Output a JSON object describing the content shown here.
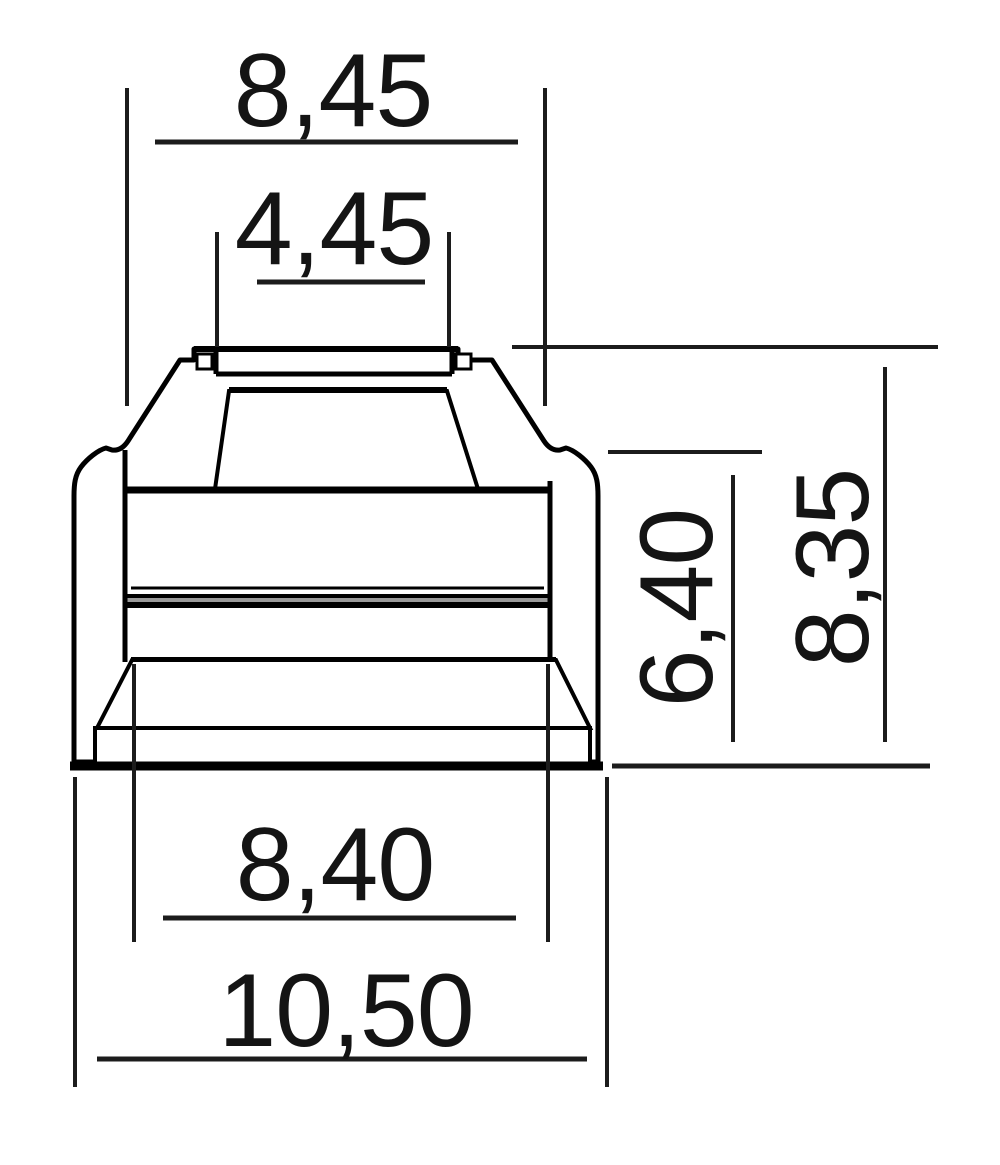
{
  "diagram": {
    "type": "technical-drawing",
    "subject": "valve-stem-seal-cross-section",
    "decimal_style": "comma",
    "colors": {
      "background": "#ffffff",
      "outline": "#000000",
      "body_fill": "#b0b0b0",
      "groove_fill": "#9a9a9a",
      "dimension_line": "#1c1c1c"
    },
    "dimensions": [
      {
        "id": "top-bore-width",
        "value": "8,45",
        "orientation": "horizontal",
        "position": "top"
      },
      {
        "id": "stem-bore-width",
        "value": "4,45",
        "orientation": "horizontal",
        "position": "top"
      },
      {
        "id": "inner-height",
        "value": "6,40",
        "orientation": "vertical",
        "position": "right"
      },
      {
        "id": "overall-height",
        "value": "8,35",
        "orientation": "vertical",
        "position": "right"
      },
      {
        "id": "base-bore-width",
        "value": "8,40",
        "orientation": "horizontal",
        "position": "bottom"
      },
      {
        "id": "overall-width",
        "value": "10,50",
        "orientation": "horizontal",
        "position": "bottom"
      }
    ]
  }
}
